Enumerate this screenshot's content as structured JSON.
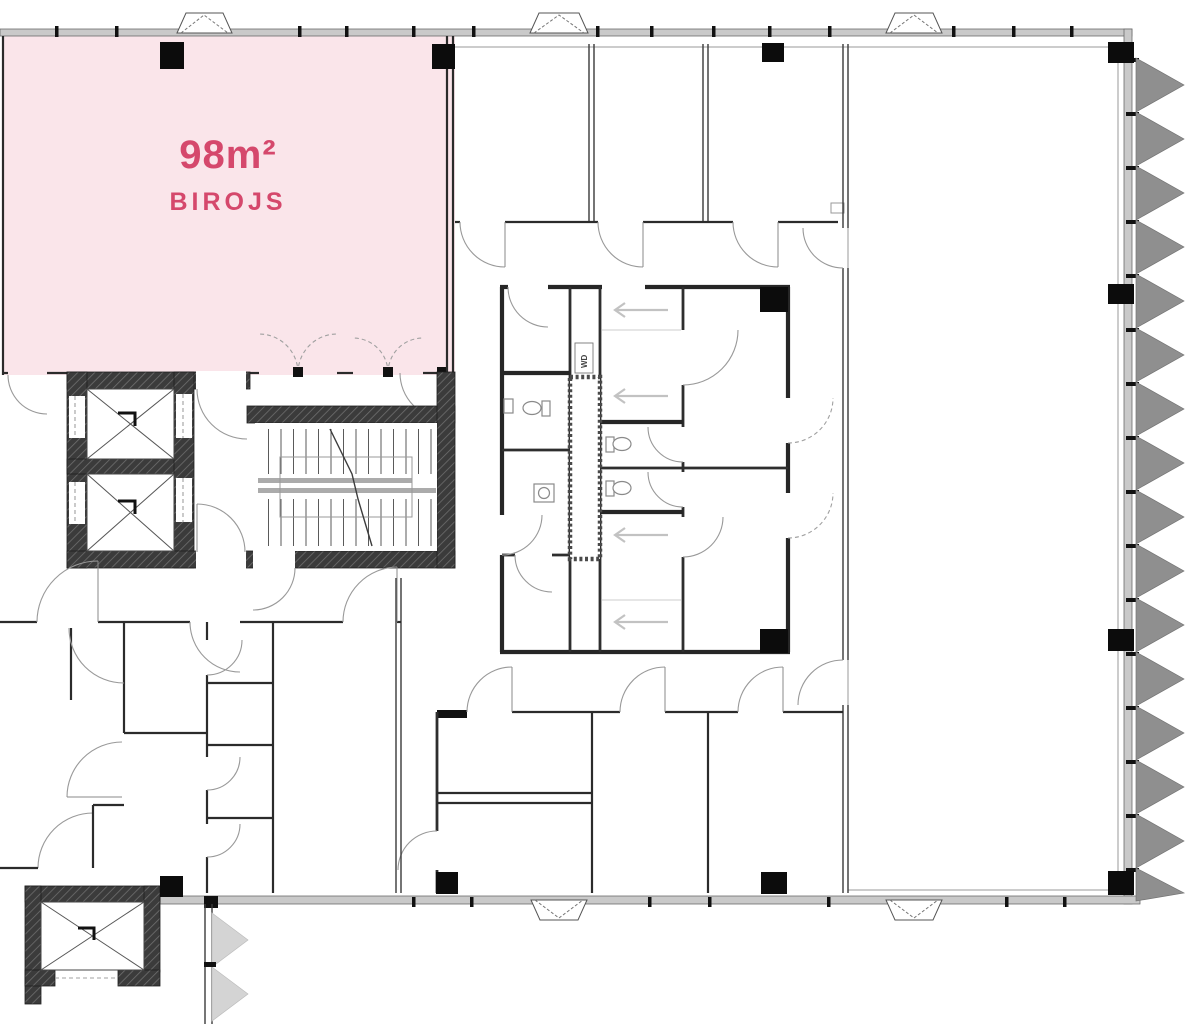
{
  "unit": {
    "area_label": "98m²",
    "name_label": "BIROJS"
  },
  "core": {
    "washer_dryer_label": "WD"
  },
  "colors": {
    "unit_fill": "#fae5ea",
    "unit_accent": "#d5486c",
    "wall_dark": "#2b2b2b",
    "exterior_band": "#c9c9c9",
    "tri": "#8f8f8f",
    "tri_light": "#d4d4d4",
    "door_arc": "#999999",
    "corridor_arrow": "#c2c2c2"
  }
}
